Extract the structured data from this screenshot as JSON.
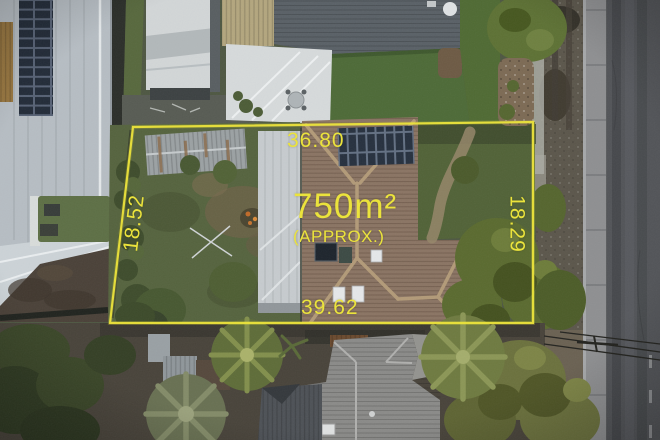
{
  "photo_overlay": {
    "area_label": "750m²",
    "area_qualifier": "(APPROX.)",
    "boundary": {
      "top_m": "36.80",
      "left_m": "18.52",
      "right_m": "18.29",
      "bottom_m": "39.62"
    },
    "overlay_color": "#ebe33c"
  },
  "scene_colors": {
    "subject_house_roof": "#8a7463",
    "garage_roof": "#c6cbce",
    "lawn_green": "#4f6a33",
    "road_asphalt": "#525458",
    "footpath_concrete": "#8e8f91"
  }
}
